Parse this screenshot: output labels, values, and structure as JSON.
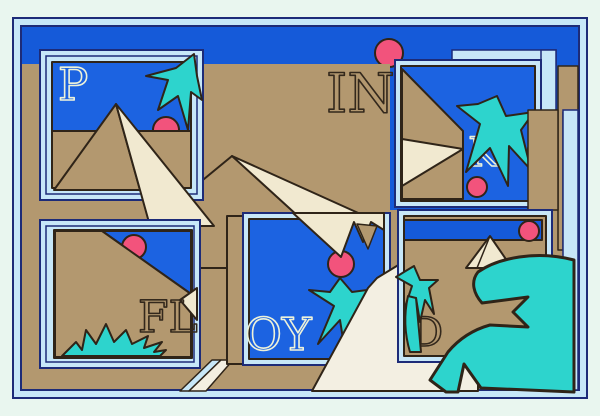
{
  "artwork": {
    "word": "PINK FLOYD",
    "letters": {
      "p": "P",
      "in": "IN",
      "k": "K",
      "fl": "FL",
      "oy": "OY",
      "d": "D"
    },
    "panels": [
      {
        "id": "panel-p",
        "letter": "P",
        "scene": "pyramid, palm tree, setting sun"
      },
      {
        "id": "panel-in",
        "letter": "IN",
        "scene": "desert sky with sun"
      },
      {
        "id": "panel-k",
        "letter": "K",
        "scene": "pyramid faces, palm tree, sun"
      },
      {
        "id": "panel-fl",
        "letter": "FL",
        "scene": "dune slope, sun, grass"
      },
      {
        "id": "panel-oy",
        "letter": "OY",
        "scene": "palm tree, sun cut by pyramid tip"
      },
      {
        "id": "panel-d",
        "letter": "D",
        "scene": "small pyramid, palms, sun"
      }
    ],
    "palette": {
      "margin": "#e9f6ef",
      "navy": "#1d2b78",
      "band": "#c7e7f8",
      "sky": "#155ad9",
      "panelBlue": "#1c63e1",
      "panelBlue2": "#1148b6",
      "tan": "#b3986f",
      "ink": "#2f2418",
      "cream": "#f1e9d0",
      "road": "#f3efe2",
      "teal": "#2dd4cd",
      "pink": "#f2537c",
      "creamLetter": "#edf2da",
      "inkLetter": "#33281c"
    }
  }
}
